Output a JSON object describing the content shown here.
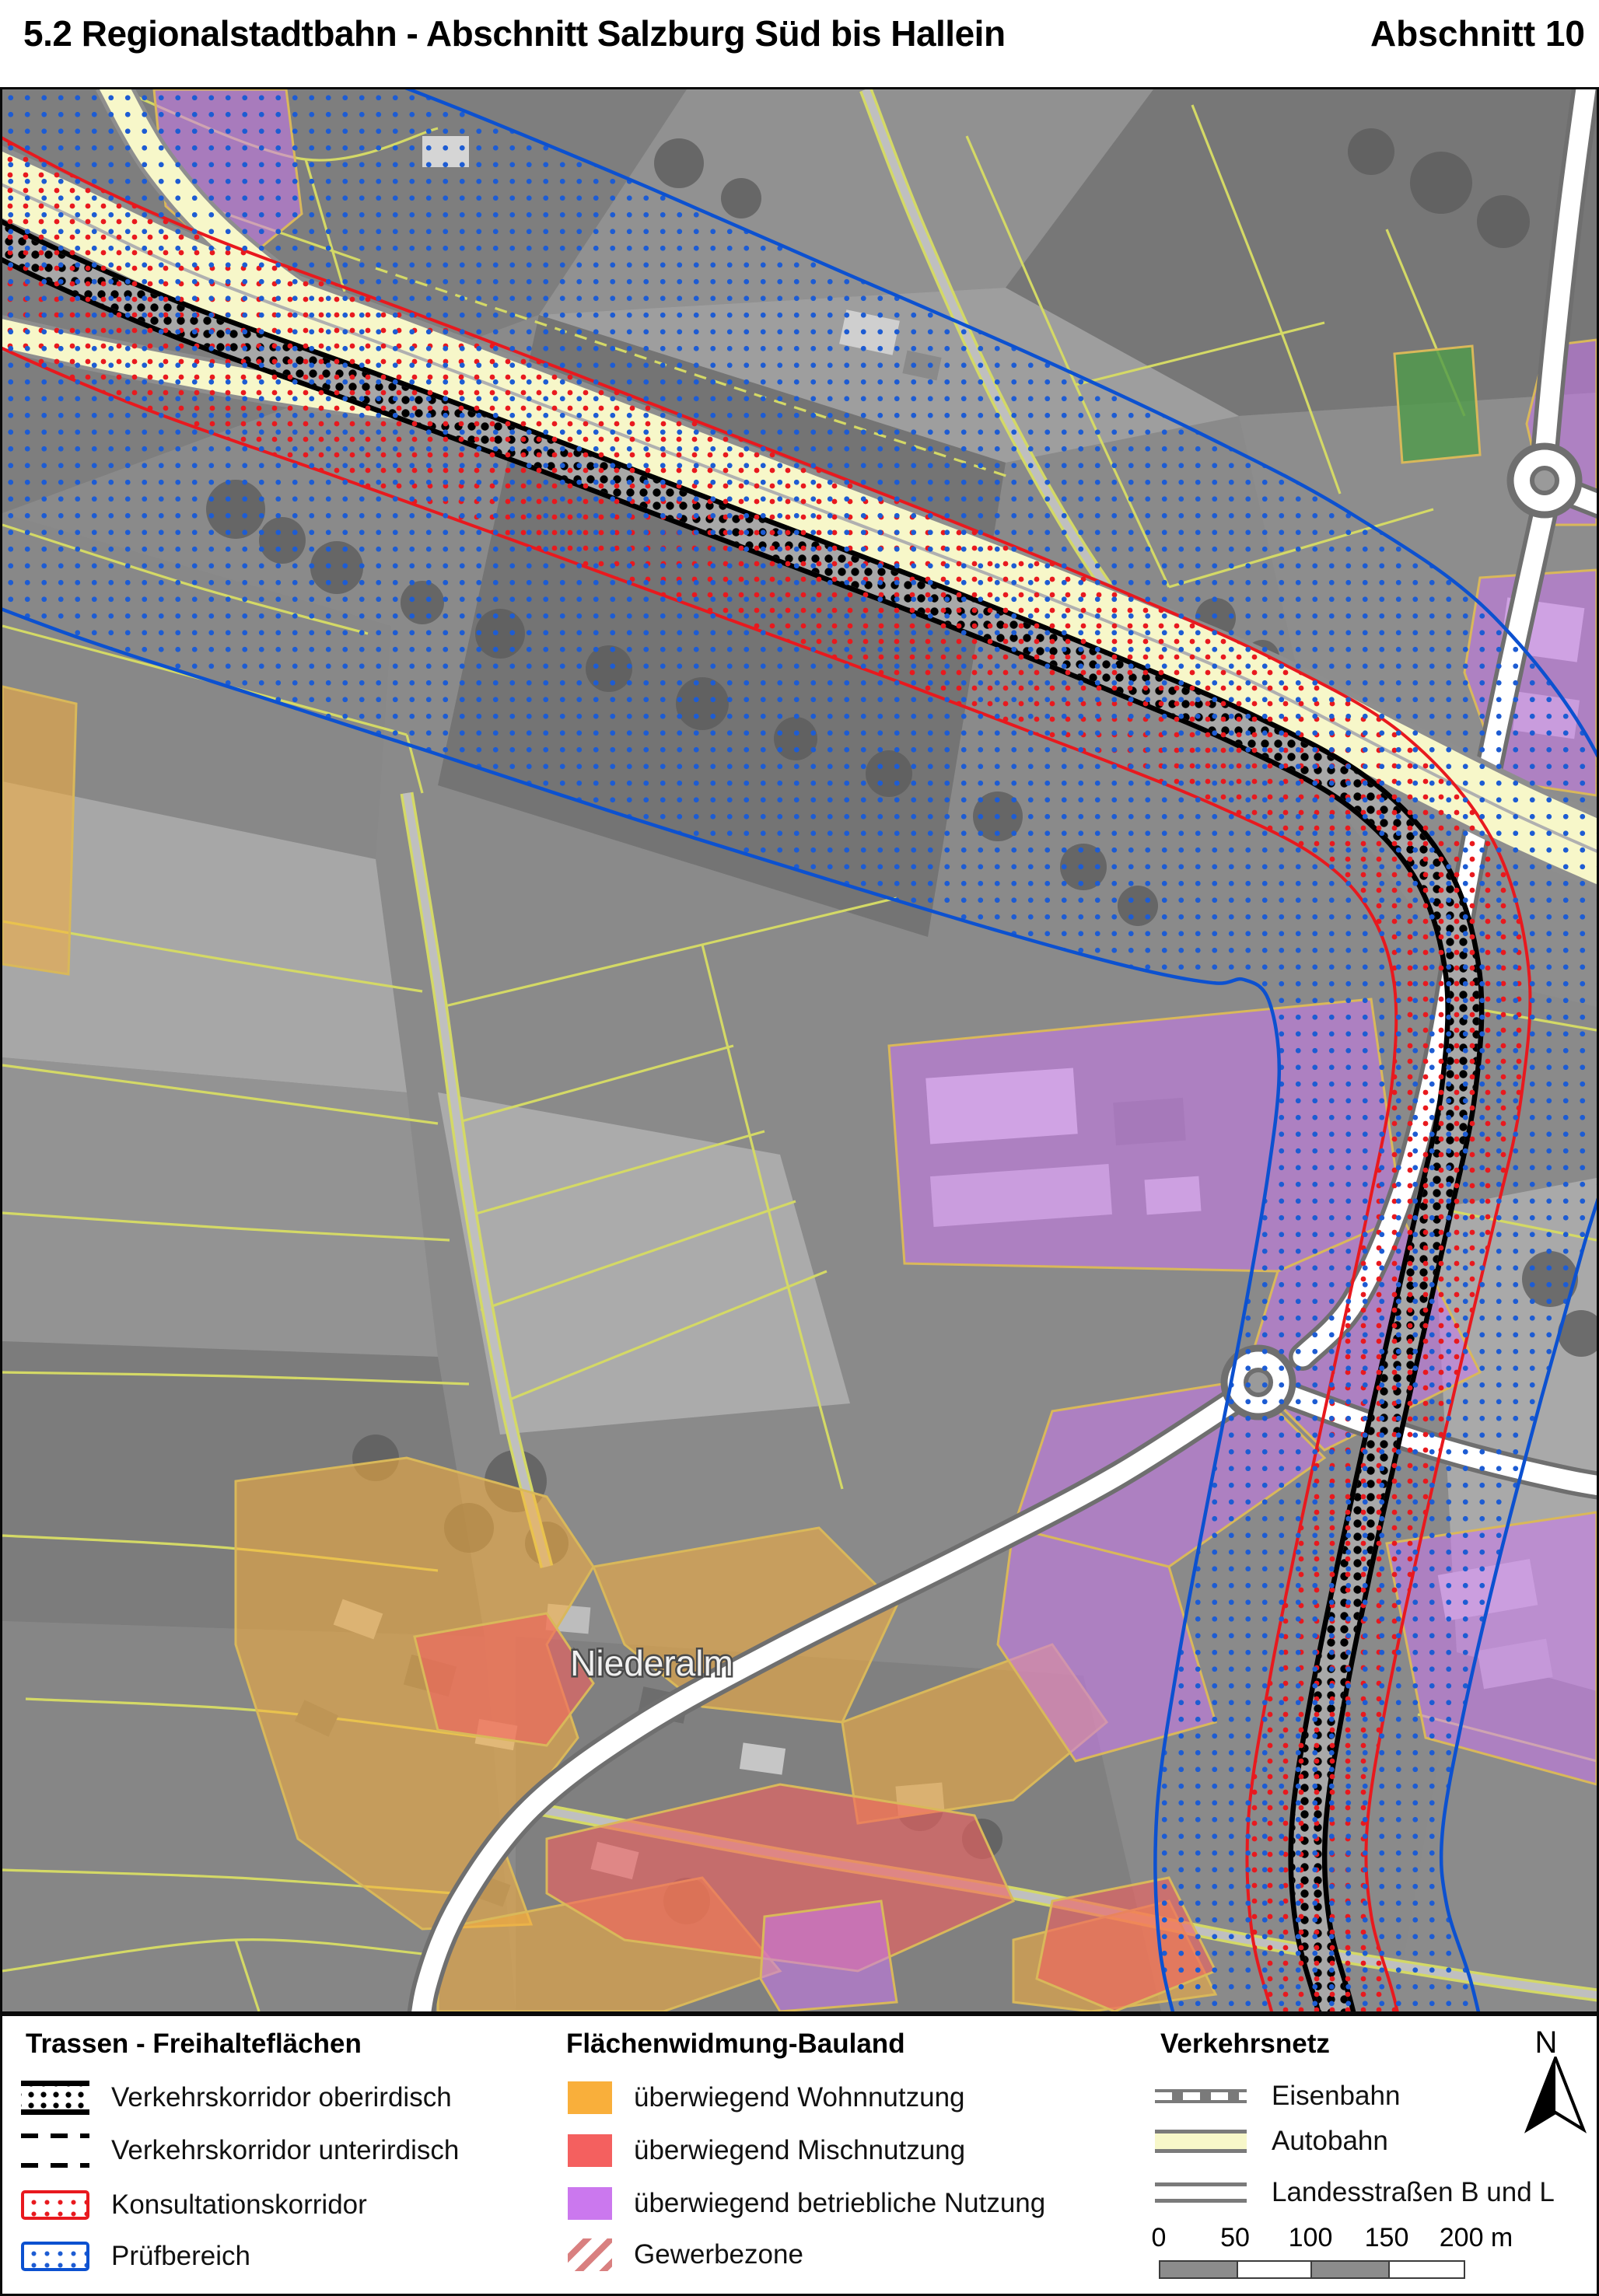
{
  "header": {
    "title": "5.2 Regionalstadtbahn - Abschnitt Salzburg Süd bis Hallein",
    "section_label": "Abschnitt 10"
  },
  "map": {
    "place_label": "Niederalm"
  },
  "legend": {
    "trassen": {
      "title": "Trassen - Freihalteflächen",
      "items": [
        {
          "id": "verkehrskorridor-oberirdisch",
          "label": "Verkehrskorridor oberirdisch"
        },
        {
          "id": "verkehrskorridor-unterirdisch",
          "label": "Verkehrskorridor unterirdisch"
        },
        {
          "id": "konsultationskorridor",
          "label": "Konsultationskorridor"
        },
        {
          "id": "pruefbereich",
          "label": "Prüfbereich"
        }
      ]
    },
    "flaechenwidmung": {
      "title": "Flächenwidmung-Bauland",
      "items": [
        {
          "id": "wohnnutzung",
          "label": "überwiegend Wohnnutzung"
        },
        {
          "id": "mischnutzung",
          "label": "überwiegend Mischnutzung"
        },
        {
          "id": "betriebliche-nutzung",
          "label": "überwiegend betriebliche Nutzung"
        },
        {
          "id": "gewerbezone",
          "label": "Gewerbezone"
        }
      ]
    },
    "verkehrsnetz": {
      "title": "Verkehrsnetz",
      "items": [
        {
          "id": "eisenbahn",
          "label": "Eisenbahn"
        },
        {
          "id": "autobahn",
          "label": "Autobahn"
        },
        {
          "id": "landesstrassen",
          "label": "Landesstraßen B und L"
        }
      ]
    },
    "scalebar": {
      "ticks": [
        "0",
        "50",
        "100",
        "150"
      ],
      "end_label": "200 m"
    },
    "north_label": "N"
  },
  "colors": {
    "korridor_schwarz": "#000000",
    "konsultation_rot": "#e8191e",
    "pruefbereich_blau": "#0c51d0",
    "wohnnutzung_orange": "#f9af3b",
    "mischnutzung_rot": "#f4605f",
    "betrieblich_violett": "#cb78ee",
    "gewerbezone_rot": "#d98080",
    "autobahn_gelb": "#f7f7c9",
    "strassen_grau": "#7a7a7a",
    "parzellen_gelb": "#d4d966"
  }
}
